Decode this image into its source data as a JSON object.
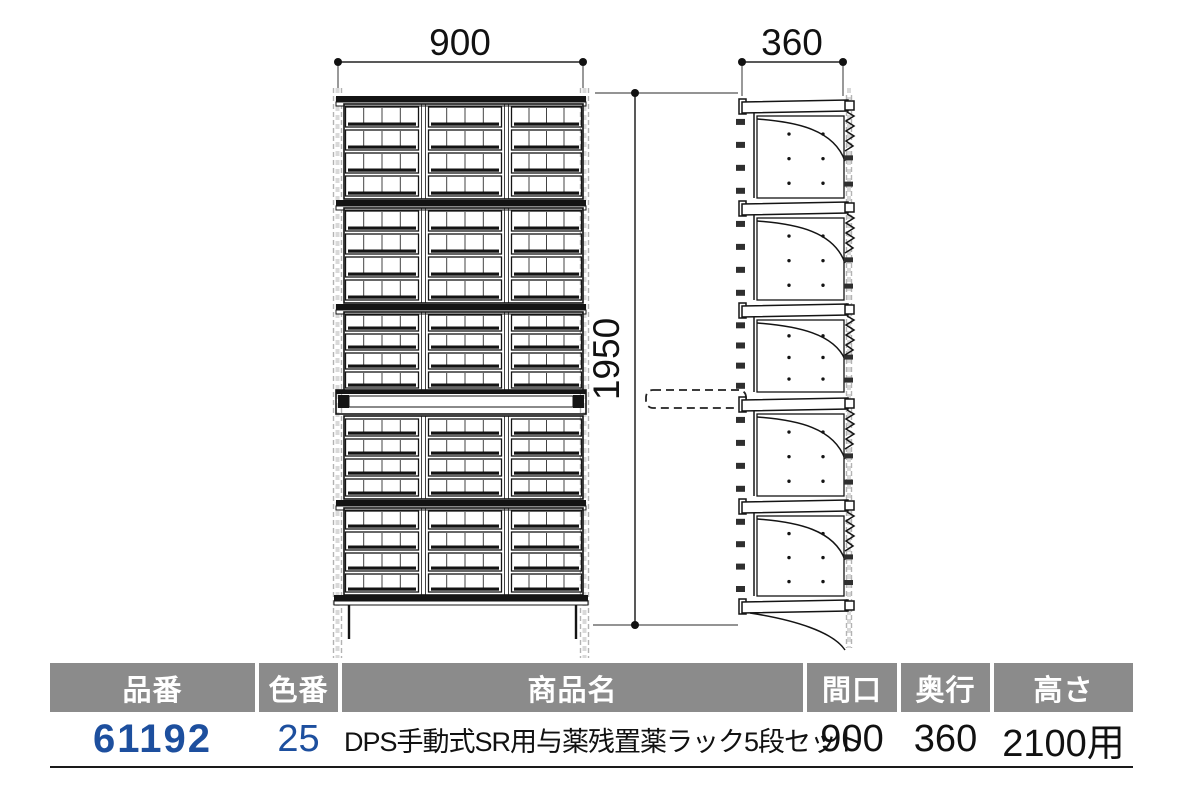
{
  "diagram": {
    "front_view": {
      "width_label": "900",
      "height_label": "1950",
      "shelf_count": 5,
      "bin_columns": 3,
      "tray_rows_per_shelf": 4,
      "tray_cells_per_bin": 4
    },
    "side_view": {
      "depth_label": "360",
      "shelf_count": 5
    }
  },
  "table": {
    "headers": [
      {
        "label": "品番"
      },
      {
        "label": "色番"
      },
      {
        "label": "商品名"
      },
      {
        "label": "間口"
      },
      {
        "label": "奥行"
      },
      {
        "label": "高さ"
      }
    ],
    "row": {
      "hinban": "61192",
      "iroban": "25",
      "shohinmei": "DPS手動式SR用与薬残置薬ラック5段セット",
      "maguchi": "900",
      "okuyuki": "360",
      "takasa": "2100用"
    }
  },
  "colors": {
    "accent_blue": "#1d4f9e",
    "header_gray": "#8b8b8b",
    "line_ink": "#141414"
  }
}
